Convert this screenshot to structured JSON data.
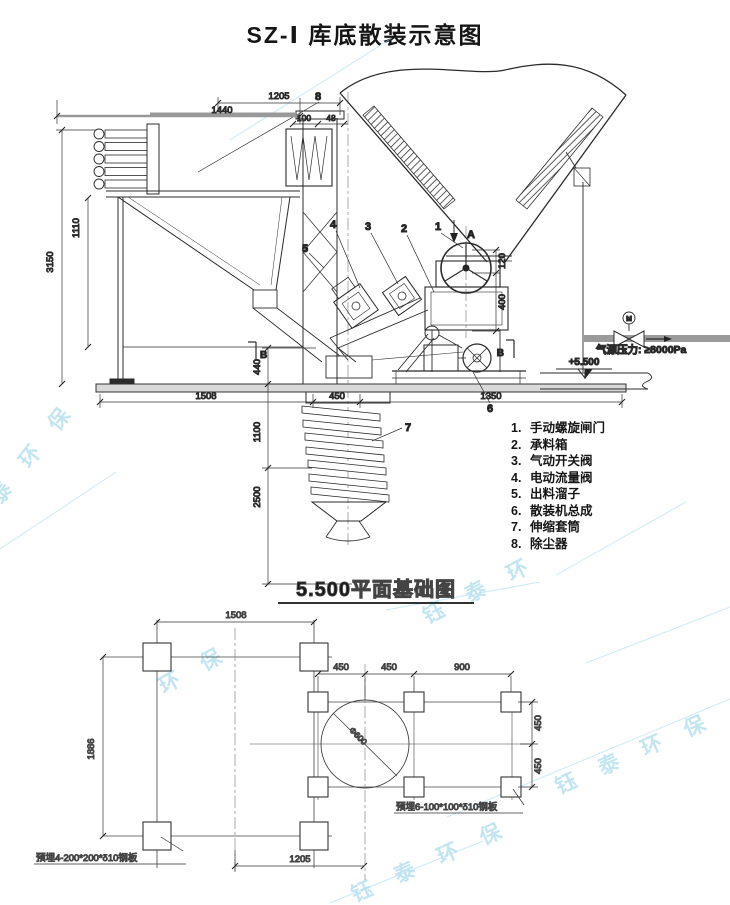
{
  "page": {
    "title": "SZ-Ⅰ 库底散装示意图"
  },
  "legend": {
    "items": [
      {
        "num": "1.",
        "label": "手动螺旋闸门"
      },
      {
        "num": "2.",
        "label": "承料箱"
      },
      {
        "num": "3.",
        "label": "气动开关阀"
      },
      {
        "num": "4.",
        "label": "电动流量阀"
      },
      {
        "num": "5.",
        "label": "出料溜子"
      },
      {
        "num": "6.",
        "label": "散装机总成"
      },
      {
        "num": "7.",
        "label": "伸缩套筒"
      },
      {
        "num": "8.",
        "label": "除尘器"
      }
    ]
  },
  "elevation": {
    "callouts": {
      "c1": "1",
      "c2": "2",
      "c3": "3",
      "c4": "4",
      "c5": "5",
      "c6": "6",
      "c7": "7",
      "c8": "8"
    },
    "arrow_label": "A",
    "section_label_left": "B",
    "section_label_right": "B",
    "level_label": "+5.500",
    "air_label": "气源压力: ≥8000Pa",
    "valve_label": "M",
    "dims": {
      "top_1205": "1205",
      "top_1440": "1440",
      "top_100": "100",
      "top_48": "48",
      "left_3150": "3150",
      "left_1110": "1110",
      "mid_440": "440",
      "mid_1100": "1100",
      "mid_2500": "2500",
      "bottom_1508": "1508",
      "bottom_450": "450",
      "bottom_1350": "1350",
      "right_120": "120",
      "right_400": "400"
    }
  },
  "plan": {
    "title": "5.500平面基础图",
    "dims": {
      "top_1508": "1508",
      "left_1886": "1886",
      "row_450a": "450",
      "row_450b": "450",
      "row_900": "900",
      "right_450a": "450",
      "right_450b": "450",
      "bottom_1205": "1205",
      "circle_dia": "Φ600"
    },
    "notes": {
      "plates6": "预埋6-100*100*δ10钢板",
      "plates4": "预埋4-200*200*δ10钢板"
    }
  },
  "watermarks": [
    {
      "text": "泰 环 保"
    },
    {
      "text": "环 保"
    },
    {
      "text": "钰 泰 环"
    },
    {
      "text": "钰 泰 环 保"
    },
    {
      "text": "钰 泰 环 保"
    }
  ]
}
